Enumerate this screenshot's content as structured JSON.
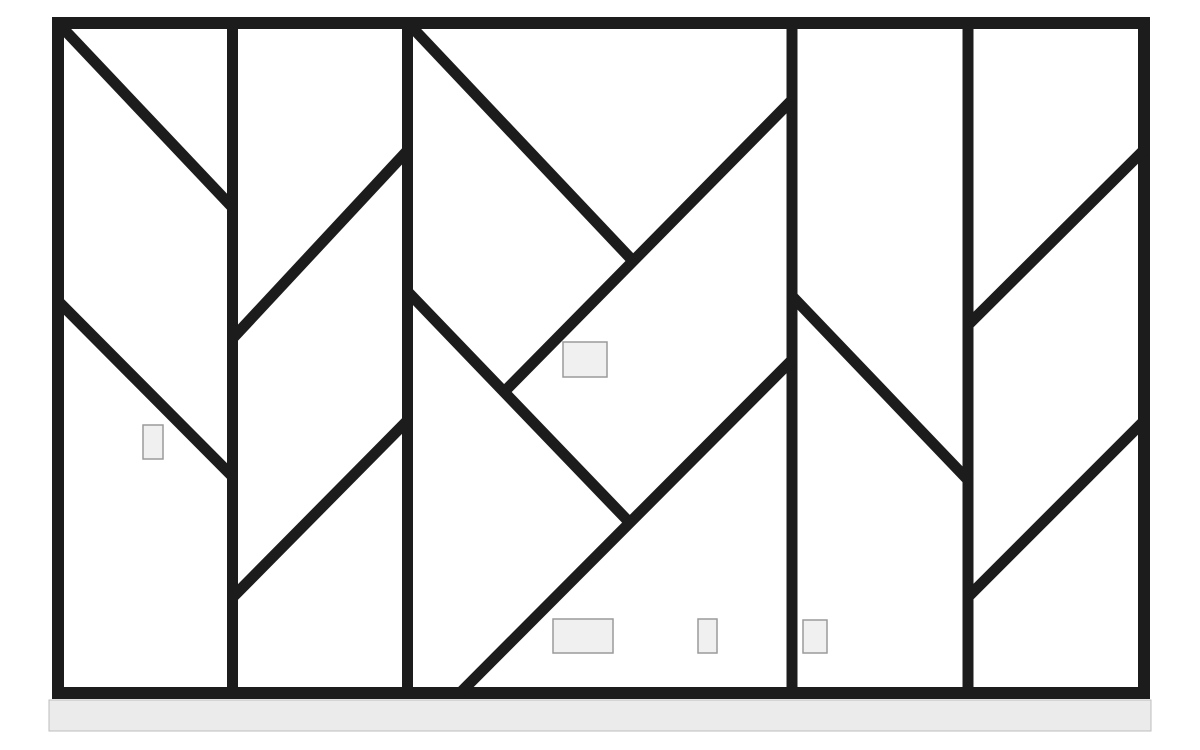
{
  "meta": {
    "description": "geometric-panel-divider-line-drawing",
    "canvas": {
      "width": 1200,
      "height": 750,
      "background": "#ffffff"
    }
  },
  "colors": {
    "line": "#1c1c1c",
    "tag_fill": "#f0f0f0",
    "tag_border": "#9a9a9a",
    "floor_fill": "#ebebeb",
    "floor_border": "#bdbdbd"
  },
  "frame": {
    "x": 58,
    "y": 23,
    "width": 1086,
    "height": 670,
    "stroke_width": 12
  },
  "mullions": {
    "stroke_width": 11,
    "y_top": 23,
    "y_bottom": 693,
    "x_positions": [
      232.5,
      407.5,
      792,
      968
    ]
  },
  "diagonals": {
    "stroke_width": 11,
    "segments": [
      {
        "name": "panel1-diagonal-upper",
        "x1": 58,
        "y1": 23,
        "x2": 233,
        "y2": 208
      },
      {
        "name": "panel1-diagonal-lower",
        "x1": 58,
        "y1": 301,
        "x2": 233,
        "y2": 477
      },
      {
        "name": "panel2-diagonal-upper",
        "x1": 233,
        "y1": 338,
        "x2": 408,
        "y2": 150
      },
      {
        "name": "panel2-diagonal-lower",
        "x1": 233,
        "y1": 597,
        "x2": 408,
        "y2": 420
      },
      {
        "name": "panel3-backslash-upper",
        "x1": 408,
        "y1": 23,
        "x2": 633,
        "y2": 261
      },
      {
        "name": "panel3-slash-upper",
        "x1": 504,
        "y1": 392,
        "x2": 792,
        "y2": 100
      },
      {
        "name": "panel3-backslash-lower",
        "x1": 408,
        "y1": 292,
        "x2": 630,
        "y2": 523
      },
      {
        "name": "panel3-slash-lower",
        "x1": 459,
        "y1": 694,
        "x2": 792,
        "y2": 360
      },
      {
        "name": "panel4-diagonal",
        "x1": 792,
        "y1": 296,
        "x2": 968,
        "y2": 480
      },
      {
        "name": "panel5-diagonal-upper",
        "x1": 968,
        "y1": 325,
        "x2": 1144,
        "y2": 150
      },
      {
        "name": "panel5-diagonal-lower",
        "x1": 968,
        "y1": 597,
        "x2": 1144,
        "y2": 421
      }
    ]
  },
  "tags": [
    {
      "name": "tag-panel1",
      "x": 143,
      "y": 425,
      "width": 20,
      "height": 34
    },
    {
      "name": "tag-panel3-middle",
      "x": 563,
      "y": 342,
      "width": 44,
      "height": 35
    },
    {
      "name": "tag-panel3-bottom-left",
      "x": 553,
      "y": 619,
      "width": 60,
      "height": 34
    },
    {
      "name": "tag-panel3-bottom-right",
      "x": 698,
      "y": 619,
      "width": 19,
      "height": 34
    },
    {
      "name": "tag-panel4-bottom",
      "x": 803,
      "y": 620,
      "width": 24,
      "height": 33
    }
  ],
  "floor": {
    "x": 49,
    "y": 700,
    "width": 1102,
    "height": 31
  }
}
